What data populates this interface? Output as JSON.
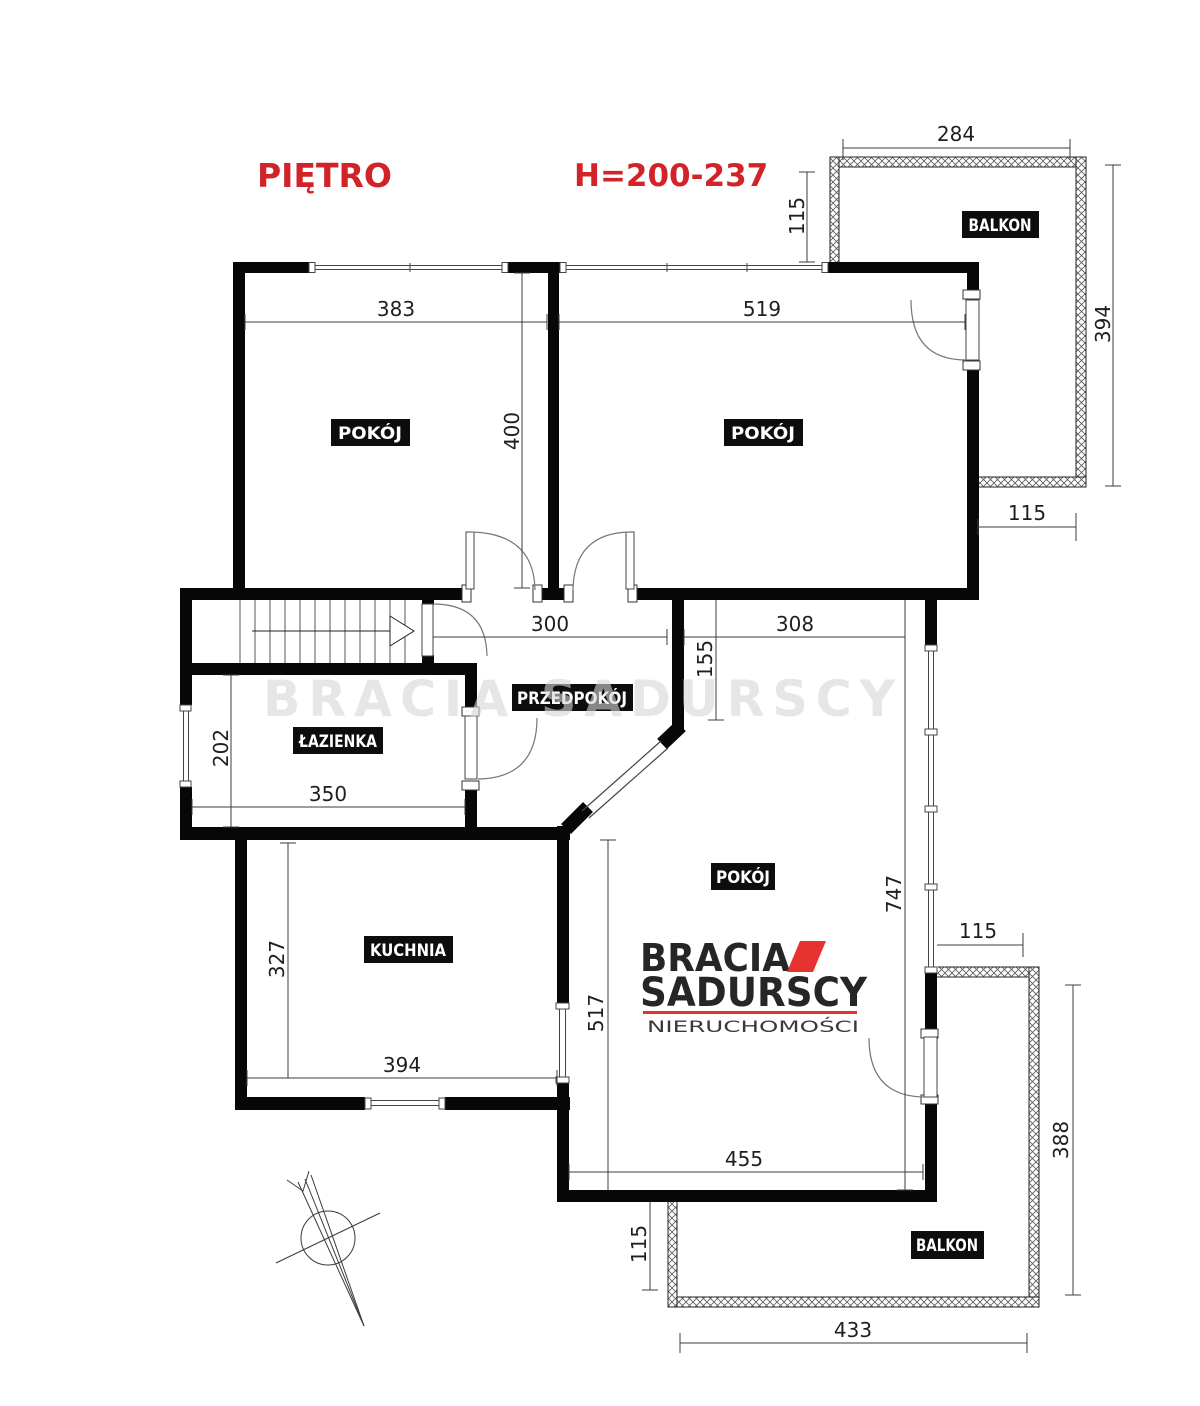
{
  "page": {
    "title_floor": "PIĘTRO",
    "title_height": "H=200-237"
  },
  "colors": {
    "accent_red": "#d22428",
    "logo_red": "#e63230",
    "wall_black": "#070707",
    "label_bg": "#0d0d0d",
    "watermark_gray": "#d7d7d7"
  },
  "labels": {
    "room_top_left": "POKÓJ",
    "room_top_right": "POKÓJ",
    "room_bottom": "POKÓJ",
    "bathroom": "ŁAZIENKA",
    "hallway": "PRZEDPOKÓJ",
    "kitchen": "KUCHNIA",
    "balcony_top": "BALKON",
    "balcony_bottom": "BALKON"
  },
  "dimensions": {
    "balcony_top_width": "284",
    "balcony_top_left_depth": "115",
    "balcony_top_height": "394",
    "balcony_top_exit_width": "115",
    "room_top_left_width": "383",
    "room_top_left_height": "400",
    "room_top_right_width": "519",
    "hall_width": "300",
    "corridor_width": "308",
    "corridor_depth": "155",
    "bathroom_height": "202",
    "bathroom_width": "350",
    "kitchen_height": "327",
    "kitchen_width": "394",
    "room_bottom_height": "517",
    "room_bottom_width": "455",
    "room_bottom_east_height": "747",
    "room_bottom_balcony_gap": "115",
    "balcony_bottom_height": "388",
    "balcony_bottom_left_depth": "115",
    "balcony_bottom_width": "433"
  },
  "logo": {
    "line1": "BRACIA",
    "line2": "SADURSCY",
    "line3": "NIERUCHOMOŚCI"
  },
  "watermark": "BRACIA SADURSCY"
}
